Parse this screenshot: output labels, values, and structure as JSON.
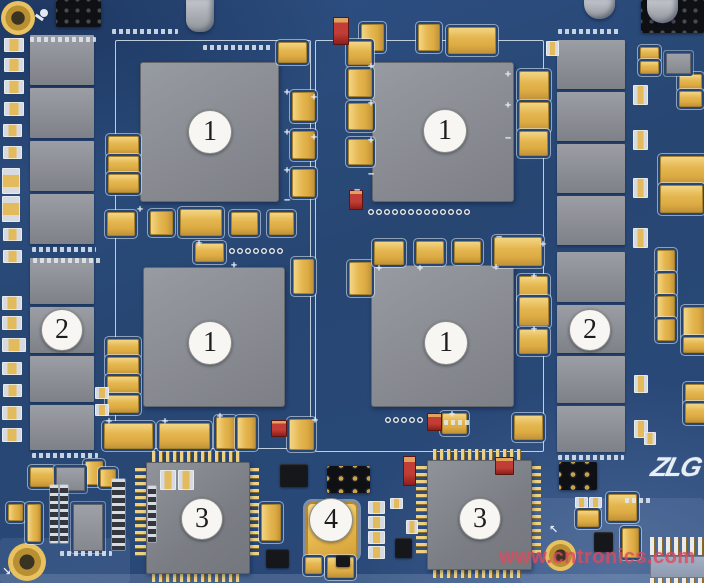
{
  "callouts": [
    {
      "id": "bga-top-left",
      "label": "1"
    },
    {
      "id": "bga-top-right",
      "label": "1"
    },
    {
      "id": "bga-bottom-left",
      "label": "1"
    },
    {
      "id": "bga-bottom-right",
      "label": "1"
    },
    {
      "id": "chip-column-left",
      "label": "2"
    },
    {
      "id": "chip-column-right",
      "label": "2"
    },
    {
      "id": "qfp-left",
      "label": "3"
    },
    {
      "id": "qfp-right",
      "label": "3"
    },
    {
      "id": "oscillator",
      "label": "4"
    }
  ],
  "logo": {
    "text": "ZLG",
    "registered_mark": "°"
  },
  "watermark": {
    "text": "www.cntronics.com"
  },
  "marks": {
    "plus": "+",
    "minus": "−",
    "arrow_ne": "↖",
    "arrow_se": "↘"
  },
  "colors": {
    "board_blue": "#274672",
    "board_blue_light": "#2e5186",
    "chip_gray": "#8b8e94",
    "chip_gray_dark": "#7a7d83",
    "cap_gold": "#e5b751",
    "cap_gold_light": "#f3d584",
    "silkscreen_white": "#e3eaf2",
    "component_black": "#15171b",
    "led_red": "#c23d35",
    "pad_gray": "#d7dbe0",
    "callout_fill": "#f7f6f3",
    "callout_text": "#1d1d1d",
    "watermark_pink": "#dc4a5e",
    "logo_white": "#e8eef6"
  }
}
